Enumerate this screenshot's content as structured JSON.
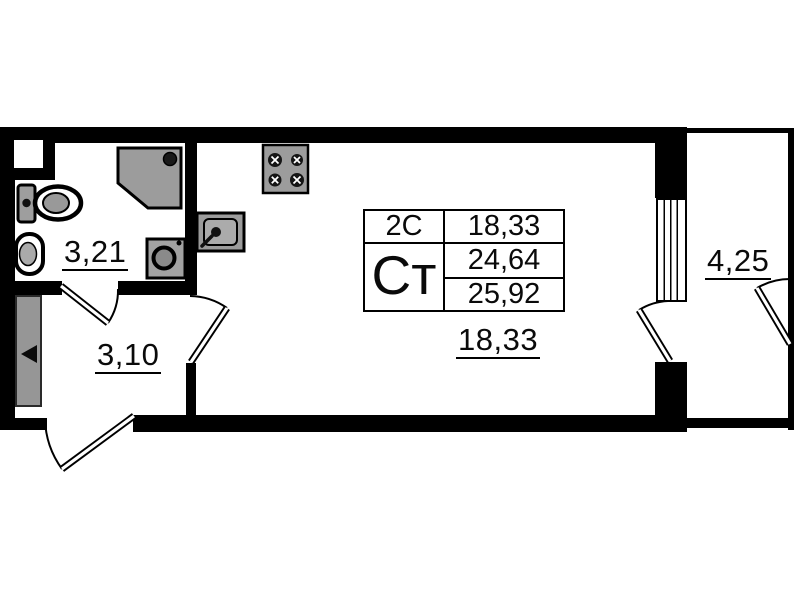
{
  "colors": {
    "wall": "#000000",
    "background": "#ffffff",
    "fixture_gray": "#9c9c9c"
  },
  "floor_plan": {
    "rooms": [
      {
        "name": "bathroom",
        "area": "3,21"
      },
      {
        "name": "hallway",
        "area": "3,10"
      },
      {
        "name": "living-room",
        "area": "18,33"
      },
      {
        "name": "balcony",
        "area": "4,25"
      }
    ],
    "info_table": {
      "type_code": "2С",
      "unit_label": "Ст",
      "living_area": "18,33",
      "area_without_balcony": "24,64",
      "area_total": "25,92"
    }
  }
}
